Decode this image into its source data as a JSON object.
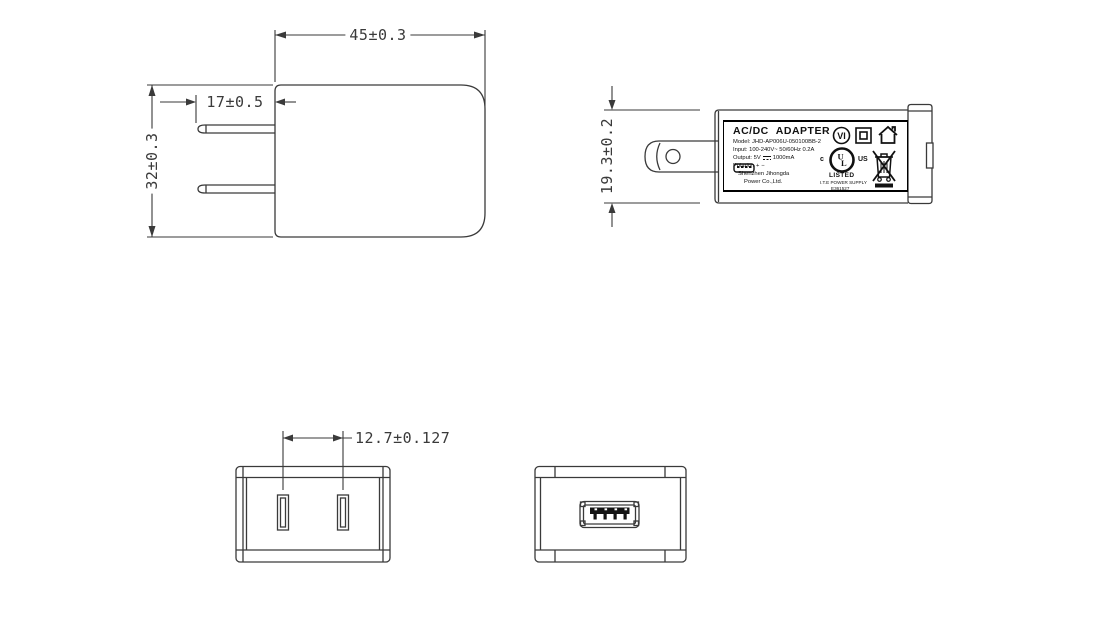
{
  "drawing_colors": {
    "line": "#3a3a3a",
    "label_line": "#111111",
    "background": "#ffffff"
  },
  "views": {
    "front": {
      "width_dim": "45±0.3",
      "blade_length_dim": "17±0.5",
      "height_dim": "32±0.3"
    },
    "side": {
      "depth_dim": "19.3±0.2"
    },
    "plug_face": {
      "blade_spacing_dim": "12.7±0.127"
    },
    "usb_face": {}
  },
  "label": {
    "title": "AC/DC ADAPTER",
    "model": "Model: JHD-AP006U-050100BB-2",
    "input": "Input: 100-240V~ 50/60Hz 0.2A",
    "output_prefix": "Output: 5V",
    "output_suffix": "1000mA",
    "polarity_label": "Polarity:",
    "polarity_plus": "+",
    "polarity_minus": "−",
    "company_line1": "Shenzhen Jihongda",
    "company_line2": "Power Co.,Ltd.",
    "efficiency_mark": "VI",
    "ul_c": "c",
    "ul_letters": "UL",
    "ul_us": "US",
    "ul_listed": "LISTED",
    "ul_type": "I.T.E POWER SUPPLY",
    "ul_file": "E361527"
  }
}
